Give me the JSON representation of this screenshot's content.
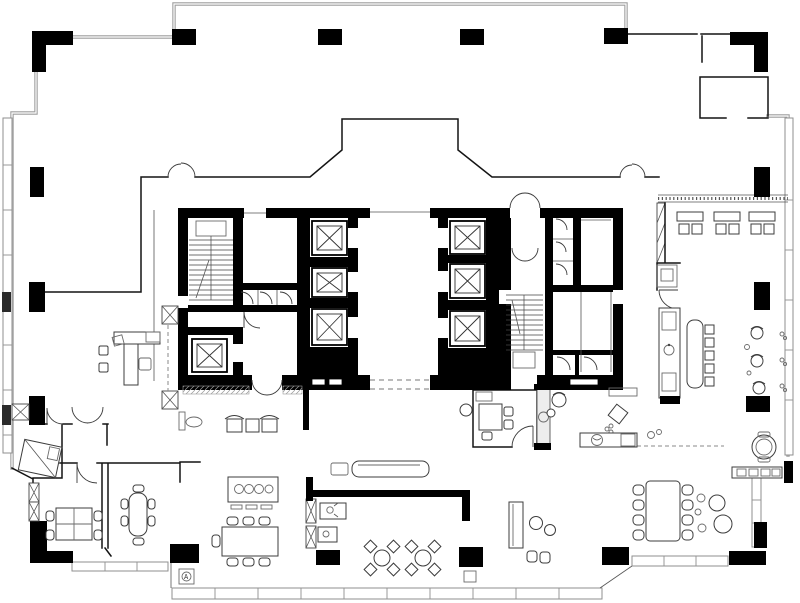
{
  "document": {
    "title": "High-rise office tower floor plan",
    "type": "architectural-floor-plan",
    "style": "black-and-white CAD drawing"
  },
  "canvas": {
    "width": 800,
    "height": 603,
    "background": "#ffffff"
  },
  "palette": {
    "structure_black": "#000000",
    "glazing_gray": "#9e9e9e",
    "thin_line": "#141414",
    "hatch_gray": "#8a8a8a",
    "cabinet_fill": "#eeeeee"
  },
  "core": {
    "passenger_elevators": 6,
    "service_elevators": 1,
    "stairwells": 2,
    "wc_cells": 7,
    "lobby_openings": 2
  },
  "areas": [
    {
      "id": "terrace-north",
      "label": "North terrace / setback"
    },
    {
      "id": "office-west",
      "label": "West office with L-desk"
    },
    {
      "id": "chaise-nook",
      "label": "Lounge nook with chaise"
    },
    {
      "id": "meeting-sw-1",
      "label": "SW meeting room, 4-seat table"
    },
    {
      "id": "meeting-sw-2",
      "label": "SW meeting room, 6-seat oval table"
    },
    {
      "id": "dining-west",
      "label": "West dining room with buffet"
    },
    {
      "id": "lobby",
      "label": "Elevator lobby and lounge"
    },
    {
      "id": "reception",
      "label": "Reception counter"
    },
    {
      "id": "cafe",
      "label": "Café seating, round tables"
    },
    {
      "id": "pantry-wc",
      "label": "Pantry / washroom block"
    },
    {
      "id": "sofa-lounge",
      "label": "Sofa lounge"
    },
    {
      "id": "meeting-mid",
      "label": "Central meeting room"
    },
    {
      "id": "lounge-east",
      "label": "East open lounge"
    },
    {
      "id": "dining-east",
      "label": "East dining room, 8-seat table"
    },
    {
      "id": "banquette-ne",
      "label": "NE banquette seating"
    },
    {
      "id": "bar-wing",
      "label": "East bar with island and stools"
    },
    {
      "id": "terrace-room-ne",
      "label": "NE terrace room"
    }
  ],
  "furniture_counts": {
    "elevator_cars": 7,
    "cafe_tables": 2,
    "dining_chairs_east": 8,
    "dining_chairs_west": 7,
    "banquette_sets": 3,
    "bar_stools": 3,
    "lounge_chairs": 2
  },
  "symbols": {
    "sign_label": "A",
    "elevator": "crossed-square",
    "door": "quarter-arc swing",
    "stair": "treads with run line",
    "shaft": "x-box",
    "entry_mat": "diagonal hatch"
  }
}
